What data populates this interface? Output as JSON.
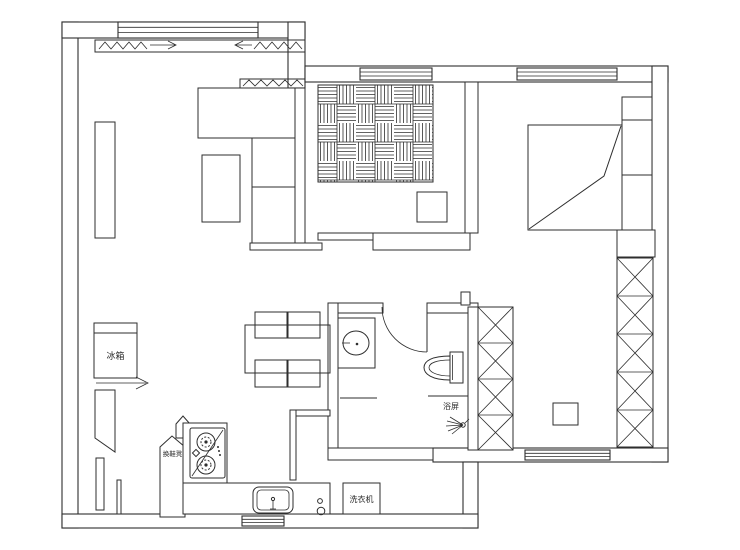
{
  "canvas": {
    "width": 740,
    "height": 550,
    "background": "#ffffff",
    "line_color": "#2e2e2e"
  },
  "labels": {
    "refrigerator": "冰箱",
    "shoe_changing_bench": "换鞋凳",
    "washing_machine": "洗衣机",
    "shower_screen": "浴屏"
  },
  "icons": {
    "bed": "bed-icon",
    "wardrobe": "wardrobe-x-icon",
    "tatami": "tatami-weave-icon",
    "stove": "gas-stove-icon",
    "kitchen_sink": "kitchen-sink-icon",
    "wash_basin": "wash-basin-icon",
    "toilet": "toilet-icon",
    "shower": "shower-head-icon",
    "door_swing": "door-arc-icon",
    "window": "window-icon"
  }
}
